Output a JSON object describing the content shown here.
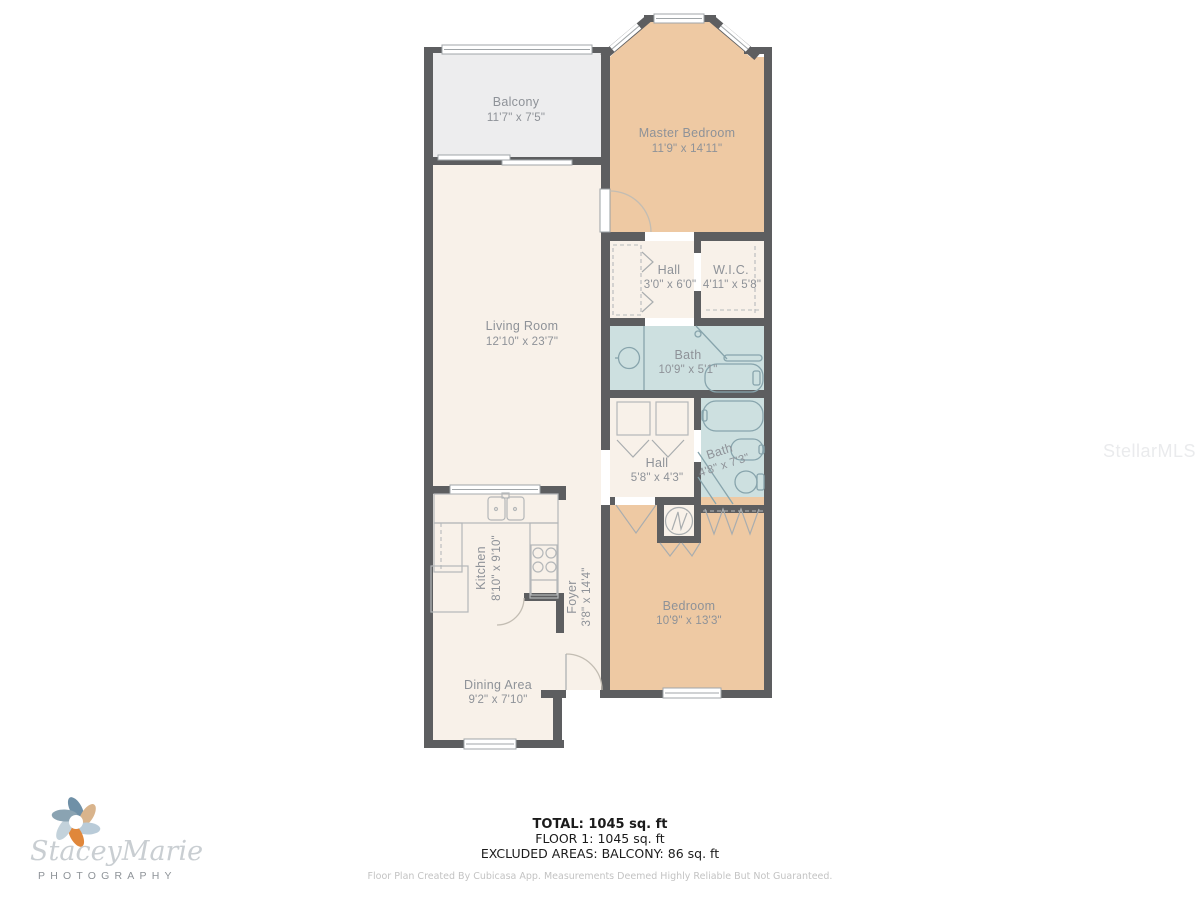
{
  "rooms": {
    "balcony": {
      "name": "Balcony",
      "dims": "11'7\" x 7'5\""
    },
    "master_bedroom": {
      "name": "Master Bedroom",
      "dims": "11'9\" x 14'11\""
    },
    "living_room": {
      "name": "Living Room",
      "dims": "12'10\" x 23'7\""
    },
    "hall_upper": {
      "name": "Hall",
      "dims": "3'0\" x 6'0\""
    },
    "wic": {
      "name": "W.I.C.",
      "dims": "4'11\" x 5'8\""
    },
    "bath_main": {
      "name": "Bath",
      "dims": "10'9\" x 5'1\""
    },
    "hall_lower": {
      "name": "Hall",
      "dims": "5'8\" x 4'3\""
    },
    "bath_second": {
      "name": "Bath",
      "dims": "4'8\" x 7'3\""
    },
    "kitchen": {
      "name": "Kitchen",
      "dims": "8'10\" x 9'10\""
    },
    "foyer": {
      "name": "Foyer",
      "dims": "3'8\" x 14'4\""
    },
    "bedroom": {
      "name": "Bedroom",
      "dims": "10'9\" x 13'3\""
    },
    "dining": {
      "name": "Dining Area",
      "dims": "9'2\" x 7'10\""
    }
  },
  "summary": {
    "total": "TOTAL: 1045 sq. ft",
    "floor1": "FLOOR 1: 1045 sq. ft",
    "excluded": "EXCLUDED AREAS: BALCONY: 86 sq. ft",
    "disclaimer": "Floor Plan Created By Cubicasa App. Measurements Deemed Highly Reliable But Not Guaranteed."
  },
  "watermark": {
    "mls": "StellarMLS"
  },
  "logo": {
    "name_script": "StaceyMarie",
    "subtitle": "PHOTOGRAPHY"
  },
  "colors": {
    "wall": "#5d5e60",
    "floor_cream": "#f8f1e9",
    "floor_tan": "#eec9a3",
    "floor_balcony": "#ededee",
    "floor_bath": "#cde0e0",
    "label_text": "#8e9298"
  }
}
